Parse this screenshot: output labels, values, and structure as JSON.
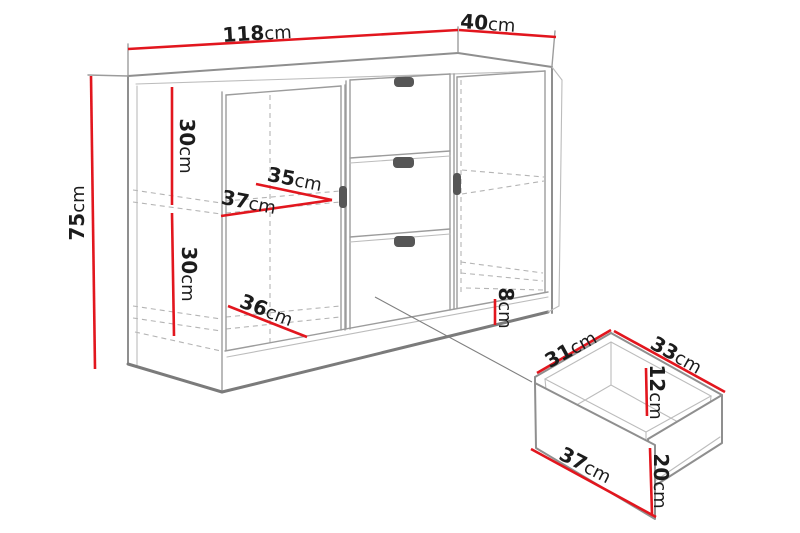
{
  "unit": "cm",
  "cabinet": {
    "width": "118",
    "depth": "40",
    "height": "75",
    "top_section_height": "30",
    "bottom_section_height": "30",
    "door_width": "35",
    "shelf_depth": "37",
    "bottom_shelf_depth": "36",
    "plinth_height": "8"
  },
  "drawer": {
    "side_depth": "31",
    "top_width": "33",
    "inner_height": "12",
    "front_width": "37",
    "front_height": "20"
  },
  "colors": {
    "dimension_line": "#e2161e",
    "outline": "#8f8f8f",
    "label_text": "#1c1c1c",
    "handle": "#565656"
  }
}
